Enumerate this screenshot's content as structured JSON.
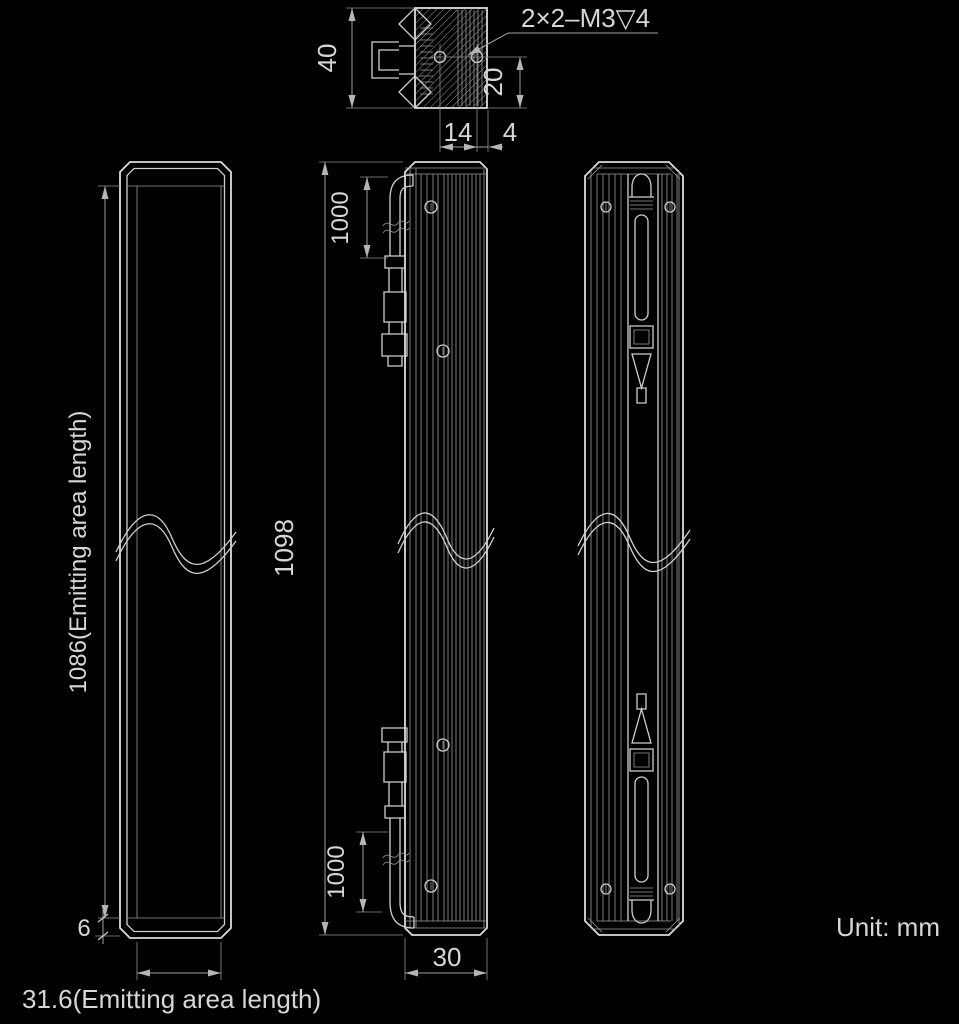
{
  "unit_note": "Unit: mm",
  "top_view": {
    "thread_callout": "2×2–M3▽4",
    "dim_overall_width": "40",
    "dim_hole_offset": "20",
    "dim_body_depth": "14",
    "dim_fin_depth": "4"
  },
  "front_view": {
    "dim_emitting_length": "1086(Emitting area length)",
    "dim_end_margin": "6",
    "dim_emitting_width": "31.6(Emitting area length)"
  },
  "side_view": {
    "dim_overall_length": "1098",
    "dim_cable_top": "1000",
    "dim_cable_bottom": "1000",
    "dim_width": "30"
  },
  "colors": {
    "background": "#000000",
    "outline": "#dcdcdc",
    "dimension": "#9f9f9f",
    "text": "#d6d6d6"
  }
}
